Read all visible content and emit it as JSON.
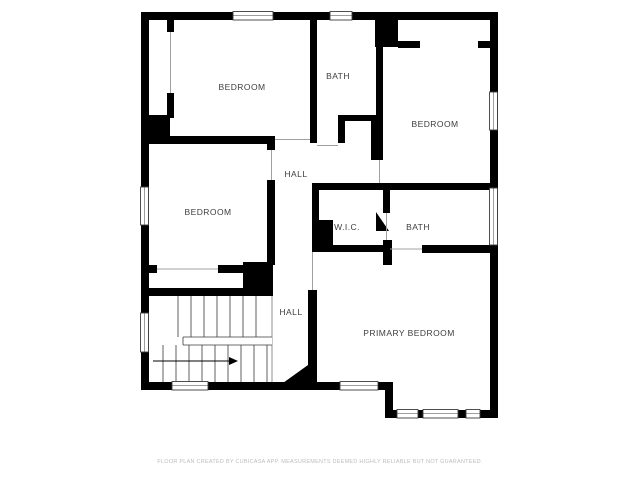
{
  "floor_plan": {
    "rooms": [
      {
        "label": "BEDROOM",
        "position": "top-left"
      },
      {
        "label": "BATH",
        "position": "top-center"
      },
      {
        "label": "BEDROOM",
        "position": "top-right"
      },
      {
        "label": "HALL",
        "position": "upper-center"
      },
      {
        "label": "BEDROOM",
        "position": "middle-left"
      },
      {
        "label": "W.I.C.",
        "position": "center"
      },
      {
        "label": "BATH",
        "position": "middle-right"
      },
      {
        "label": "HALL",
        "position": "lower-center"
      },
      {
        "label": "PRIMARY BEDROOM",
        "position": "bottom-right"
      }
    ],
    "stairs": {
      "arrow_icon": "stair-direction-arrow-right"
    },
    "footer_disclaimer": "FLOOR PLAN CREATED BY CUBICASA APP. MEASUREMENTS DEEMED HIGHLY RELIABLE BUT NOT GUARANTEED.",
    "colors": {
      "wall": "#000000",
      "floor": "#ffffff",
      "room_label": "#3d3d3d",
      "disclaimer": "#bdbdbd",
      "window_frame": "#3c3c3c",
      "opening_line": "#a0a0a0"
    }
  }
}
